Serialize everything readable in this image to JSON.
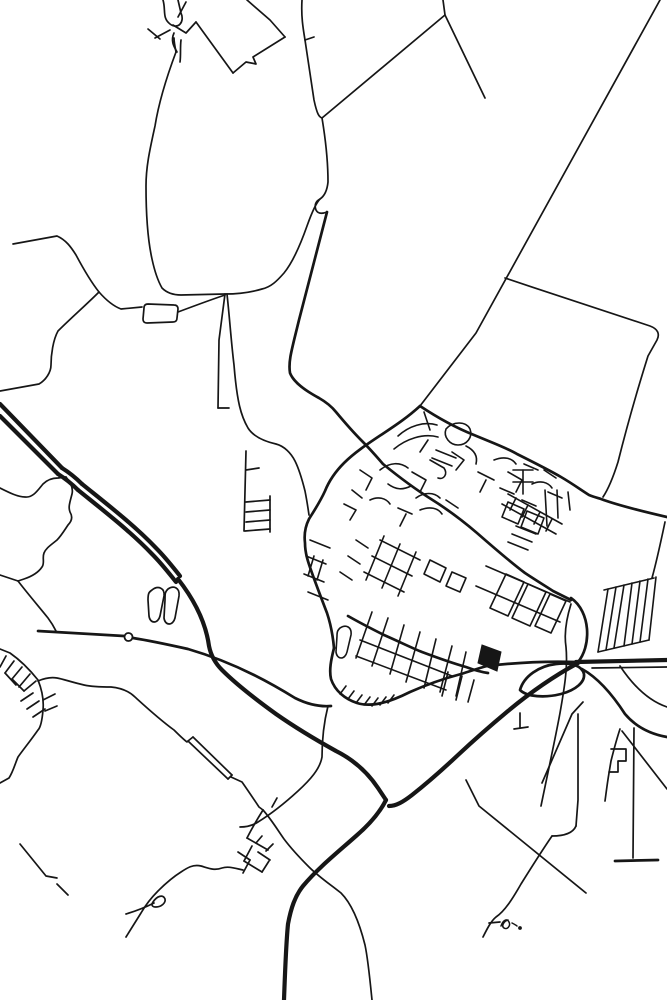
{
  "meta": {
    "description": "Minimalist black and white street map poster of a small town: dense street core at center, motorways crossing the lower half, rural field boundary lines in the north, small signature squiggle glyph near the bottom.",
    "background": "#ffffff",
    "ink": "#161616"
  },
  "canvas": {
    "width": 667,
    "height": 1000
  },
  "map": {
    "circles": [
      {
        "name": "roundabout",
        "cx": 128.5,
        "cy": 637,
        "r": 4,
        "width": 1.8
      },
      {
        "name": "glyph-dot",
        "cx": 520,
        "cy": 928,
        "r": 1.3,
        "width": 1.2,
        "filled": true
      }
    ],
    "fills": [
      {
        "name": "flyover-solid",
        "d": "M482 645 L501 652 L497 671 L478 663 Z"
      }
    ],
    "layers": [
      {
        "name": "motorways",
        "width": 4.2,
        "paths": [
          "M0 404 L62 468",
          "M0 416 L58 474",
          "M62 468 C70 473 76 478 82 484",
          "M58 474 C66 479 72 484 78 490",
          "M82 484 C108 505 134 525 156 548 C166 558 172 566 180 576",
          "M78 490 C104 511 130 531 152 554 C162 564 168 572 176 582",
          "M178 579 C196 602 206 624 209 646 C211 656 215 663 222 670 C238 686 258 701 276 714 C296 728 318 741 336 751 C352 759 366 770 378 788 L386 800",
          "M578 663 C556 675 532 691 508 711 C490 726 473 741 458 755 C442 770 426 784 412 795 C403 802 396 806 389 806",
          "M386 800 C380 812 370 824 356 836 C338 852 318 868 303 886 C295 896 291 908 288 924 C286 944 285 972 284 1000",
          "M576 662 L667 660"
        ]
      },
      {
        "name": "main-roads",
        "width": 2.7,
        "paths": [
          "M520 690 C524 676 539 666 556 664 C572 662 582 666 584 674 C585 682 576 690 561 694 C545 698 527 697 520 690 Z",
          "M571 598 C581 605 586 617 587 629 C588 643 584 655 578 662",
          "M582 669 C600 679 614 697 625 714 C636 727 650 734 667 737",
          "M420 406 C408 417 396 425 384 433 C369 443 355 452 344 463 C335 472 329 481 325 491 C320 502 314 511 309 519 C305 527 304 535 305 543 C305 553 308 562 312 573 C317 587 322 600 327 613 C331 625 333 637 334 648",
          "M420 406 C441 420 459 429 474 435 C493 443 507 448 517 454 C533 462 549 470 561 477 C573 484 581 490 589 495 C594 497 598 498 601 499 C617 505 641 511 667 517",
          "M327 212 C319 242 309 281 299 320 C292 349 288 361 290 373 C294 383 306 391 319 398 C326 402 332 407 336 412 C346 424 354 433 362 441 C370 449 377 457 383 464",
          "M383 464 C399 477 415 489 431 499 C447 509 463 521 477 533 C493 547 509 561 525 573 C537 581 547 587 553 591 C561 595 567 598 571 600",
          "M348 616 C362 624 374 630 384 635 C400 642 412 648 422 652 C438 658 452 663 466 667 C474 670 481 672 488 673",
          "M334 648 C331 660 329 670 331 679 C335 691 345 699 357 703 C373 708 392 701 410 692 C428 684 446 678 461 674 C471 671 479 668 487 666",
          "M487 666 C512 663 544 661 576 662",
          "M615 861 L658 860",
          "M38 631 L124 636",
          "M133 638 C152 641 170 645 188 649 C212 656 234 665 254 675 C268 682 282 690 295 698 C307 704 319 707 331 706"
        ]
      },
      {
        "name": "rural-roads",
        "width": 1.7,
        "paths": [
          "M163 0 C166 10 162 18 170 24 C178 30 185 22 181 13 L178 0",
          "M186 2 L178 17",
          "M173 25 L186 33 L196 22",
          "M155 38 L170 30",
          "M148 29 L160 39",
          "M181 40 C180 48 181 55 180 62",
          "M196 22 L233 73",
          "M174 33 C170 42 175 48 177 52",
          "M247 0 L270 20 L285 37",
          "M285 37 L253 57 L256 64 L246 62 L233 73",
          "M302 0 C301 16 303 28 305 40 C308 60 311 80 314 100 C317 114 319 117 322 118 C326 142 328 166 328 182 C327 192 323 197 320 199 C316 201 314 205 316 210 C318 214 322 214 327 212",
          "M305 40 L314 37",
          "M445 15 L322 118",
          "M443 0 L445 15 L485 98",
          "M660 0 L476 333 L420 406",
          "M505 278 C556 295 610 313 650 326 C658 329 660 334 657 340 L648 356 C637 391 626 430 618 462 C612 481 607 491 603 497",
          "M176 52 C167 76 159 101 155 126 C150 149 146 166 146 186 C146 216 148 241 152 259 C155 273 158 281 162 288 C167 293 173 295 181 295 L225 294 C240 294 252 292 262 289 C271 287 277 281 284 273 C293 262 301 243 307 226 C312 212 316 203 320 199",
          "M176 52 C175 47 174 42 174 38",
          "M225 294 L219 340 L218 408",
          "M218 408 L229 408",
          "M227 294 C230 322 231 340 234 365 C237 402 241 416 248 428 C253 436 263 441 276 444 C284 446 291 453 295 461 C299 469 302 479 305 491 C307 501 308 508 309 515",
          "M13 244 L57 236 C66 240 71 247 76 255 C84 270 91 282 99 292 C106 300 113 306 121 309 L142 307",
          "M148 304 Q144 304 144 308 L143 319 Q143 323 147 323 L173 322 Q177 322 177 318 L178 309 Q178 305 174 305 Z",
          "M178 312 C194 306 210 300 225 295",
          "M99 292 C86 305 71 318 58 331 C53 340 51 355 51 365 C51 372 46 380 39 384 L0 391",
          "M0 488 C10 493 18 497 25 497 C33 498 38 490 43 484 C48 479 53 478 58 478 L66 477",
          "M66 477 C72 484 73 490 72 494 C70 502 68 507 70 512 C73 517 72 521 68 525 C64 531 61 536 57 540 C51 545 46 548 44 553 C42 558 45 563 42 567 C38 573 30 577 24 579 L18 581",
          "M0 575 L18 581",
          "M18 581 C28 594 40 608 48 618 C51 622 54 627 56 631",
          "M246 451 L244 531",
          "M246 502 L270 500",
          "M246 512 L270 510",
          "M246 522 L270 520",
          "M245 531 L270 529",
          "M270 496 L270 532",
          "M246 470 L259 468",
          "M152 590 C158 585 165 588 164 596 L160 616 C158 624 150 624 149 616 L148 600 C148 593 149 592 152 590 Z",
          "M168 589 C174 585 180 588 179 596 L175 618 C173 626 165 626 164 618 L165 600 C165 593 165 592 168 589 Z",
          "M578 714 L578 800 L576 826",
          "M576 826 C573 833 564 836 552 836",
          "M552 836 C541 852 531 868 521 884 C513 898 505 911 496 917 C491 921 487 929 483 937",
          "M489 923 L500 922",
          "M466 780 C471 790 475 798 479 806 L586 893",
          "M634 728 L633 858",
          "M620 729 C616 741 613 753 611 761 L609 773 C607 785 606 794 605 801",
          "M611 749 L626 749 L626 761 L618 761 L618 772 L609 772",
          "M622 731 L667 789",
          "M620 666 C636 690 652 702 667 707",
          "M583 702 L572 714 L542 783",
          "M520 713 L520 728",
          "M514 729 L528 727",
          "M571 604 C566 620 564 634 566 647 C568 668 564 690 560 713 C555 740 548 772 541 806",
          "M652 578 C657 560 661 541 665 522",
          "M592 668 L667 667",
          "M328 706 C324 722 322 740 322 757 C320 769 310 780 298 791 C286 802 271 814 258 822 C252 826 246 827 240 827",
          "M272 807 L277 798",
          "M38 681 C45 678 51 677 57 678 C63 679 71 682 84 685 C93 687 103 687 111 687 C121 688 129 691 135 697 C146 707 159 719 174 730 C179 735 183 739 187 742",
          "M188 741 L228 779",
          "M193 737 L232 775",
          "M188 741 L193 737",
          "M228 779 L232 775",
          "M231 777 L242 782 C249 792 255 801 259 807 L263 810",
          "M263 810 C271 819 277 829 284 839 C293 851 301 859 309 867 C319 877 331 885 341 893 C351 903 359 921 365 945 C368 959 370 980 372 1000",
          "M263 810 C258 818 252 828 247 838",
          "M247 838 L268 850",
          "M252 846 L244 861",
          "M258 852 L270 860",
          "M244 861 L262 872",
          "M262 872 L269 861",
          "M238 852 L250 860",
          "M250 860 L243 873",
          "M256 843 L262 836",
          "M266 851 L273 844",
          "M243 870 C234 868 228 866 222 868 C214 871 208 868 201 866 C193 864 187 868 181 872 C173 877 165 884 158 891 C151 898 145 906 141 913 C136 921 131 929 126 937",
          "M126 914 C136 911 146 907 154 903",
          "M153 902 C157 896 163 894 165 899 C166 903 161 907 156 907 C152 907 151 905 153 902 Z",
          "M20 844 L46 876 L57 878",
          "M57 884 L68 895",
          "M0 649 L10 653 C20 660 30 670 38 680 C42 690 44 700 43 710 C42 722 40 728 38 730 C31 740 23 750 18 757 C15 764 13 772 9 778 L0 783",
          "M6 656 L0 667",
          "M14 661 L5 673",
          "M22 667 L12 679",
          "M30 674 L19 687",
          "M5 673 L16 685",
          "M12 679 L24 691",
          "M24 691 L36 681",
          "M21 701 L33 693",
          "M27 709 L39 701",
          "M33 717 L45 709",
          "M43 700 L55 694",
          "M45 711 L57 706"
        ]
      },
      {
        "name": "town-streets",
        "width": 1.6,
        "paths": [
          "M398 436 C409 426 424 421 437 425",
          "M394 449 C406 439 423 433 438 437",
          "M446 429 C453 421 466 421 470 429 C473 437 467 445 458 445 C450 445 443 437 446 429",
          "M380 470 C390 462 400 462 408 468",
          "M412 472 L426 480 L420 492",
          "M430 460 L444 468 C448 474 444 480 438 478",
          "M388 484 C396 490 403 490 411 486",
          "M416 498 C424 492 434 492 440 498",
          "M360 470 L372 478 L366 490",
          "M370 500 C378 496 386 498 390 504",
          "M352 490 L362 498",
          "M344 504 L356 510 L350 520",
          "M398 508 L412 514",
          "M406 514 L400 526",
          "M420 510 C430 506 438 508 442 514",
          "M446 500 L458 508",
          "M428 440 L420 452",
          "M452 452 L464 460 L456 470",
          "M466 446 C474 450 478 456 476 464",
          "M432 458 L452 466",
          "M436 450 L456 458",
          "M478 472 L494 480",
          "M486 480 L480 492",
          "M494 460 C504 456 512 458 516 464",
          "M500 488 L514 494",
          "M508 472 L522 480 L516 492",
          "M524 464 L538 470",
          "M532 484 C540 480 548 482 552 488",
          "M522 500 L536 506",
          "M544 470 L556 478",
          "M548 492 L562 498",
          "M513 470 L533 470",
          "M513 482 L533 482",
          "M523 470 L523 494",
          "M545 490 L547 526",
          "M557 490 L558 518",
          "M568 492 L570 510",
          "M508 494 L562 524",
          "M502 504 L556 534",
          "M516 498 L510 510",
          "M528 505 L522 517",
          "M540 512 L534 524",
          "M552 519 L546 531",
          "M508 502 L524 509 L518 524 L502 517 Z",
          "M527 511 L544 518 L538 534 L521 527 Z",
          "M508 542 L528 550",
          "M512 534 L532 542",
          "M516 526 L536 534",
          "M380 540 L420 560",
          "M372 556 L412 576",
          "M364 572 L404 592",
          "M384 536 L366 580",
          "M400 544 L382 588",
          "M416 552 L398 596",
          "M430 560 L446 568 L440 582 L424 574 Z",
          "M452 572 L466 578 L460 592 L446 586 Z",
          "M356 540 L368 548",
          "M348 556 L360 564",
          "M340 572 L352 580",
          "M486 566 L570 602",
          "M476 586 L560 622",
          "M506 574 L524 582 L508 616 L490 608 Z",
          "M528 584 L546 592 L530 626 L512 618 Z",
          "M550 594 L566 601 L551 633 L535 626 Z",
          "M372 612 L356 658",
          "M388 618 L372 666",
          "M404 625 L390 674",
          "M420 632 L406 682",
          "M436 639 L424 688",
          "M452 646 L440 692",
          "M466 652 L456 696",
          "M360 640 L452 676",
          "M356 656 L446 690",
          "M310 540 L330 548",
          "M306 556 L326 564",
          "M304 574 L324 582",
          "M308 592 L328 600",
          "M314 556 L308 576",
          "M323 560 L317 580",
          "M340 628 C346 624 352 627 351 635 L347 652 C345 660 337 660 336 652 L337 636 C337 631 338 630 340 628 Z",
          "M340 694 L346 686",
          "M348 699 L354 691",
          "M356 703 L362 695",
          "M364 705 L370 697",
          "M372 706 L378 698",
          "M380 705 L386 697",
          "M388 703 L394 695",
          "M462 676 L456 700",
          "M474 680 L468 702",
          "M448 672 L442 696",
          "M604 590 L654 578",
          "M608 589 L598 652",
          "M616 587 L606 650",
          "M624 585 L614 648",
          "M632 583 L624 646",
          "M640 581 L632 644",
          "M648 579 L640 642",
          "M656 577 L649 640",
          "M598 652 L649 640",
          "M424 412 L430 430"
        ]
      },
      {
        "name": "signature-glyph",
        "width": 1.5,
        "paths": [
          "M501 926 C503 920 507 918 509 922 C511 926 507 930 504 928 C501 926 504 921 508 920",
          "M512 923 C514 924 516 925 517 926"
        ]
      }
    ]
  }
}
